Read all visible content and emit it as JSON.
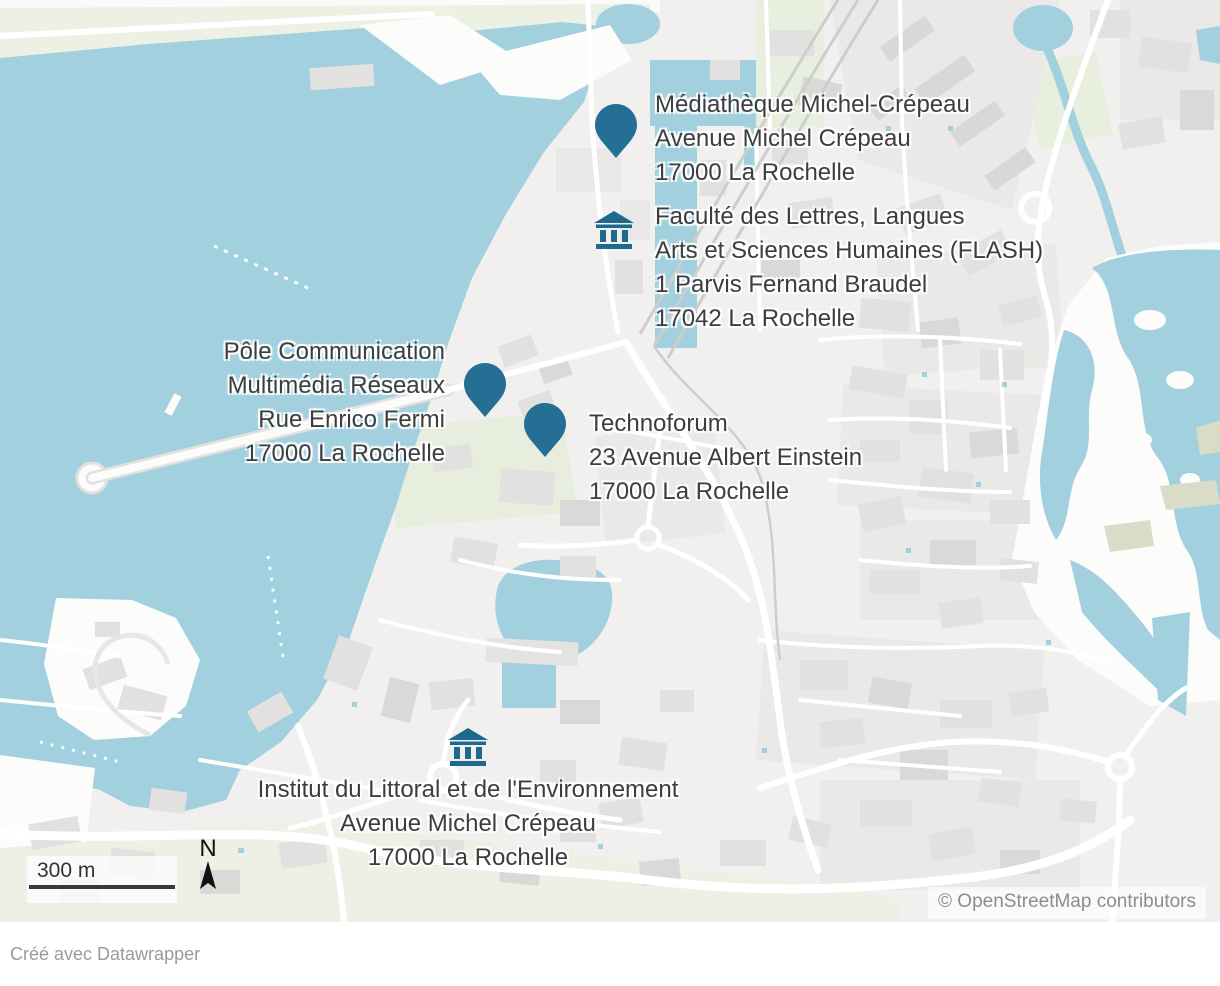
{
  "map": {
    "attribution": "© OpenStreetMap contributors",
    "scale_label": "300 m",
    "north_label": "N",
    "markers": [
      {
        "kind": "pin",
        "lines": [
          "Médiathèque Michel-Crépeau",
          "Avenue Michel Crépeau",
          "17000 La Rochelle"
        ]
      },
      {
        "kind": "building",
        "lines": [
          "Faculté des Lettres, Langues",
          "Arts et Sciences Humaines (FLASH)",
          "1 Parvis Fernand Braudel",
          "17042 La Rochelle"
        ]
      },
      {
        "kind": "pin",
        "lines": [
          "Pôle Communication",
          "Multimédia Réseaux",
          "Rue Enrico Fermi",
          "17000 La Rochelle"
        ]
      },
      {
        "kind": "pin",
        "lines": [
          "Technoforum",
          "23 Avenue Albert Einstein",
          "17000 La Rochelle"
        ]
      },
      {
        "kind": "building",
        "lines": [
          "Institut du Littoral et de l'Environnement",
          "Avenue Michel Crépeau",
          "17000 La Rochelle"
        ]
      }
    ],
    "colors": {
      "water": "#a3d0de",
      "land": "#f1f0ee",
      "marker": "#256f94",
      "label_text": "#3d3d3d"
    }
  },
  "footer": {
    "credit": "Créé avec Datawrapper"
  }
}
